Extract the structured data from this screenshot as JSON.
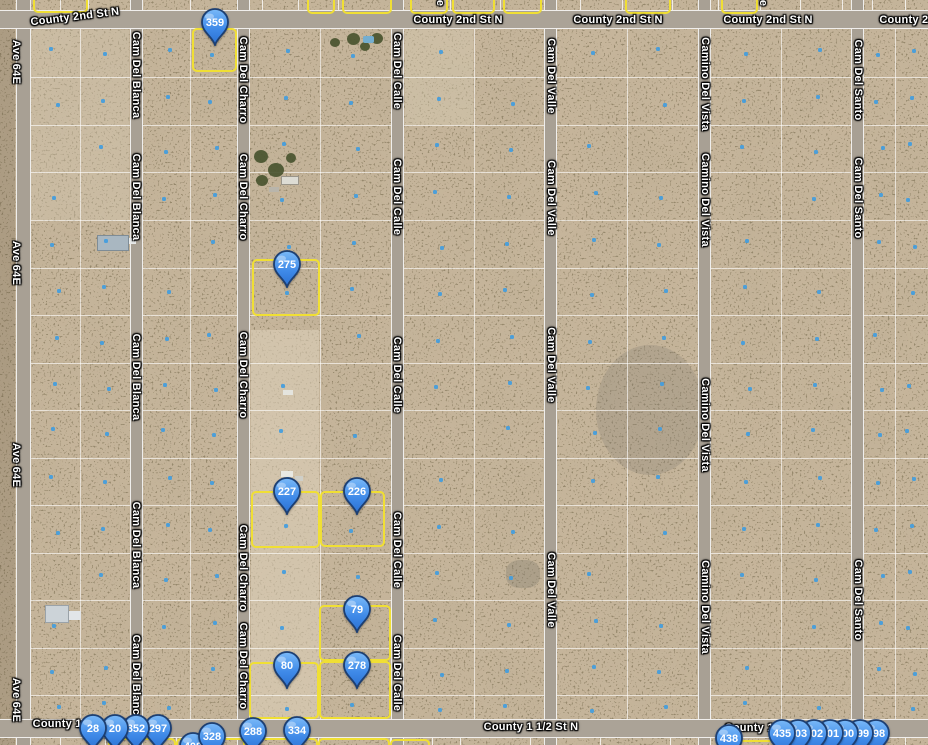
{
  "map_view": {
    "width": 928,
    "height": 745,
    "colors": {
      "terrain": "#c7b69c",
      "road": "#a8a094",
      "grid_line": "#ffffff",
      "parcel_highlight": "#f0df34",
      "pin_fill": "#3f8ae8",
      "pin_outline": "#1d3f72",
      "parcel_dot": "#3f9ce0",
      "label_text": "#ffffff"
    },
    "horizontal_roads": [
      {
        "name": "County 2nd St N",
        "y": 10,
        "h": 19
      },
      {
        "name": "County 1 1/2 St N",
        "y": 719,
        "h": 19
      }
    ],
    "vertical_roads": [
      {
        "name": "Ave 64E",
        "x": 16,
        "w": 15
      },
      {
        "name": "Cam Del Blanca",
        "x": 130,
        "w": 13
      },
      {
        "name": "Cam Del Charro",
        "x": 237,
        "w": 13
      },
      {
        "name": "Cam Del Calle",
        "x": 391,
        "w": 13
      },
      {
        "name": "Cam Del Valle",
        "x": 544,
        "w": 13
      },
      {
        "name": "Camino Del Vista",
        "x": 698,
        "w": 13
      },
      {
        "name": "Cam Del Santo",
        "x": 851,
        "w": 13
      }
    ],
    "road_labels": [
      {
        "text": "County 2nd St N",
        "x": 75,
        "y": 17,
        "rot": -7
      },
      {
        "text": "County 2nd St N",
        "x": 458,
        "y": 20
      },
      {
        "text": "County 2nd St N",
        "x": 618,
        "y": 20
      },
      {
        "text": "County 2nd St N",
        "x": 768,
        "y": 20
      },
      {
        "text": "County 2nd St N",
        "x": 924,
        "y": 20
      },
      {
        "text": "County 1 1/2 St N",
        "x": 80,
        "y": 724
      },
      {
        "text": "County 1 1/2 St N",
        "x": 531,
        "y": 727
      },
      {
        "text": "County 1 1/2 St N",
        "x": 772,
        "y": 728
      },
      {
        "text": "Ave 64E",
        "x": 16,
        "y": 62,
        "vertical": true
      },
      {
        "text": "Ave 64E",
        "x": 16,
        "y": 263,
        "vertical": true
      },
      {
        "text": "Ave 64E",
        "x": 16,
        "y": 465,
        "vertical": true
      },
      {
        "text": "Ave 64E",
        "x": 16,
        "y": 700,
        "vertical": true
      },
      {
        "text": "Cam Del Blanca",
        "x": 136,
        "y": 75,
        "vertical": true
      },
      {
        "text": "Cam Del Blanca",
        "x": 136,
        "y": 197,
        "vertical": true
      },
      {
        "text": "Cam Del Blanca",
        "x": 136,
        "y": 377,
        "vertical": true
      },
      {
        "text": "Cam Del Blanca",
        "x": 136,
        "y": 545,
        "vertical": true
      },
      {
        "text": "Cam Del Blanca",
        "x": 136,
        "y": 678,
        "vertical": true
      },
      {
        "text": "Cam Del Charro",
        "x": 243,
        "y": 80,
        "vertical": true
      },
      {
        "text": "Cam Del Charro",
        "x": 243,
        "y": 197,
        "vertical": true
      },
      {
        "text": "Cam Del Charro",
        "x": 243,
        "y": 375,
        "vertical": true
      },
      {
        "text": "Cam Del Charro",
        "x": 243,
        "y": 568,
        "vertical": true
      },
      {
        "text": "Cam Del Charro",
        "x": 243,
        "y": 666,
        "vertical": true
      },
      {
        "text": "Cam Del Calle",
        "x": 397,
        "y": 71,
        "vertical": true
      },
      {
        "text": "Cam Del Calle",
        "x": 397,
        "y": 197,
        "vertical": true
      },
      {
        "text": "Cam Del Calle",
        "x": 397,
        "y": 375,
        "vertical": true
      },
      {
        "text": "Cam Del Calle",
        "x": 397,
        "y": 550,
        "vertical": true
      },
      {
        "text": "Cam Del Calle",
        "x": 397,
        "y": 673,
        "vertical": true
      },
      {
        "text": "Cam Del Valle",
        "x": 551,
        "y": 76,
        "vertical": true
      },
      {
        "text": "Cam Del Valle",
        "x": 551,
        "y": 198,
        "vertical": true
      },
      {
        "text": "Cam Del Valle",
        "x": 551,
        "y": 365,
        "vertical": true
      },
      {
        "text": "Cam Del Valle",
        "x": 551,
        "y": 590,
        "vertical": true
      },
      {
        "text": "Camino Del Vista",
        "x": 705,
        "y": 84,
        "vertical": true
      },
      {
        "text": "Camino Del Vista",
        "x": 705,
        "y": 200,
        "vertical": true
      },
      {
        "text": "Camino Del Vista",
        "x": 705,
        "y": 425,
        "vertical": true
      },
      {
        "text": "Camino Del Vista",
        "x": 705,
        "y": 607,
        "vertical": true
      },
      {
        "text": "Cam Del Santo",
        "x": 858,
        "y": 80,
        "vertical": true
      },
      {
        "text": "Cam Del Santo",
        "x": 858,
        "y": 198,
        "vertical": true
      },
      {
        "text": "Cam Del Santo",
        "x": 858,
        "y": 600,
        "vertical": true
      },
      {
        "text": "e",
        "x": 440,
        "y": 3,
        "vertical": true
      },
      {
        "text": "e",
        "x": 763,
        "y": 3,
        "vertical": true
      }
    ],
    "pins": [
      {
        "label": "359",
        "x": 215,
        "y": 23
      },
      {
        "label": "275",
        "x": 287,
        "y": 265
      },
      {
        "label": "227",
        "x": 287,
        "y": 492
      },
      {
        "label": "226",
        "x": 357,
        "y": 492
      },
      {
        "label": "79",
        "x": 357,
        "y": 610
      },
      {
        "label": "80",
        "x": 287,
        "y": 666
      },
      {
        "label": "278",
        "x": 357,
        "y": 666
      },
      {
        "label": "408",
        "x": 193,
        "y": 747
      },
      {
        "label": "328",
        "x": 212,
        "y": 737
      },
      {
        "label": "297",
        "x": 158,
        "y": 729
      },
      {
        "label": "352",
        "x": 136,
        "y": 729
      },
      {
        "label": "20",
        "x": 115,
        "y": 729
      },
      {
        "label": "28",
        "x": 93,
        "y": 729
      },
      {
        "label": "288",
        "x": 253,
        "y": 732
      },
      {
        "label": "334",
        "x": 297,
        "y": 731
      },
      {
        "label": "438",
        "x": 729,
        "y": 739
      },
      {
        "label": "498",
        "x": 876,
        "y": 734
      },
      {
        "label": "499",
        "x": 860,
        "y": 734
      },
      {
        "label": "500",
        "x": 845,
        "y": 734
      },
      {
        "label": "501",
        "x": 830,
        "y": 734
      },
      {
        "label": "502",
        "x": 814,
        "y": 734
      },
      {
        "label": "503",
        "x": 798,
        "y": 734
      },
      {
        "label": "435",
        "x": 782,
        "y": 734
      }
    ],
    "highlighted_parcels": [
      [
        192,
        28,
        45,
        44
      ],
      [
        252,
        259,
        68,
        57
      ],
      [
        251,
        491,
        69,
        57
      ],
      [
        320,
        491,
        65,
        56
      ],
      [
        319,
        605,
        72,
        56
      ],
      [
        249,
        662,
        70,
        57
      ],
      [
        319,
        661,
        72,
        58
      ],
      [
        33,
        -6,
        55,
        19
      ],
      [
        307,
        -6,
        28,
        20
      ],
      [
        342,
        -6,
        50,
        20
      ],
      [
        410,
        -6,
        38,
        20
      ],
      [
        452,
        -6,
        43,
        20
      ],
      [
        503,
        -6,
        39,
        20
      ],
      [
        625,
        -6,
        46,
        20
      ],
      [
        721,
        -6,
        37,
        20
      ],
      [
        108,
        738,
        68,
        14
      ],
      [
        176,
        738,
        69,
        14
      ],
      [
        247,
        738,
        71,
        14
      ],
      [
        318,
        738,
        72,
        14
      ],
      [
        390,
        739,
        40,
        13
      ],
      [
        737,
        740,
        58,
        12
      ]
    ],
    "grid": {
      "column_split_lines": [
        80,
        190,
        320,
        474,
        627,
        781,
        895
      ],
      "row_lines": [
        77,
        125,
        172,
        220,
        268,
        315,
        363,
        410,
        458,
        505,
        553,
        600,
        648,
        695
      ],
      "top_strip_dividers": [
        60,
        88,
        140,
        190,
        240,
        262,
        298,
        338,
        395,
        450,
        500,
        545,
        580,
        622,
        672,
        718,
        760,
        800,
        842,
        872,
        905
      ],
      "bottom_strip_dividers": [
        60,
        105,
        176,
        245,
        318,
        390,
        432,
        460,
        530,
        600,
        670,
        700,
        737,
        797,
        828,
        860,
        905
      ],
      "dot_columns": [
        55,
        105,
        166,
        213,
        285,
        355,
        439,
        509,
        592,
        662,
        746,
        816,
        879,
        911
      ],
      "dot_rows": [
        53,
        101,
        148,
        196,
        244,
        291,
        339,
        386,
        432,
        481,
        529,
        576,
        624,
        671,
        707
      ]
    }
  }
}
